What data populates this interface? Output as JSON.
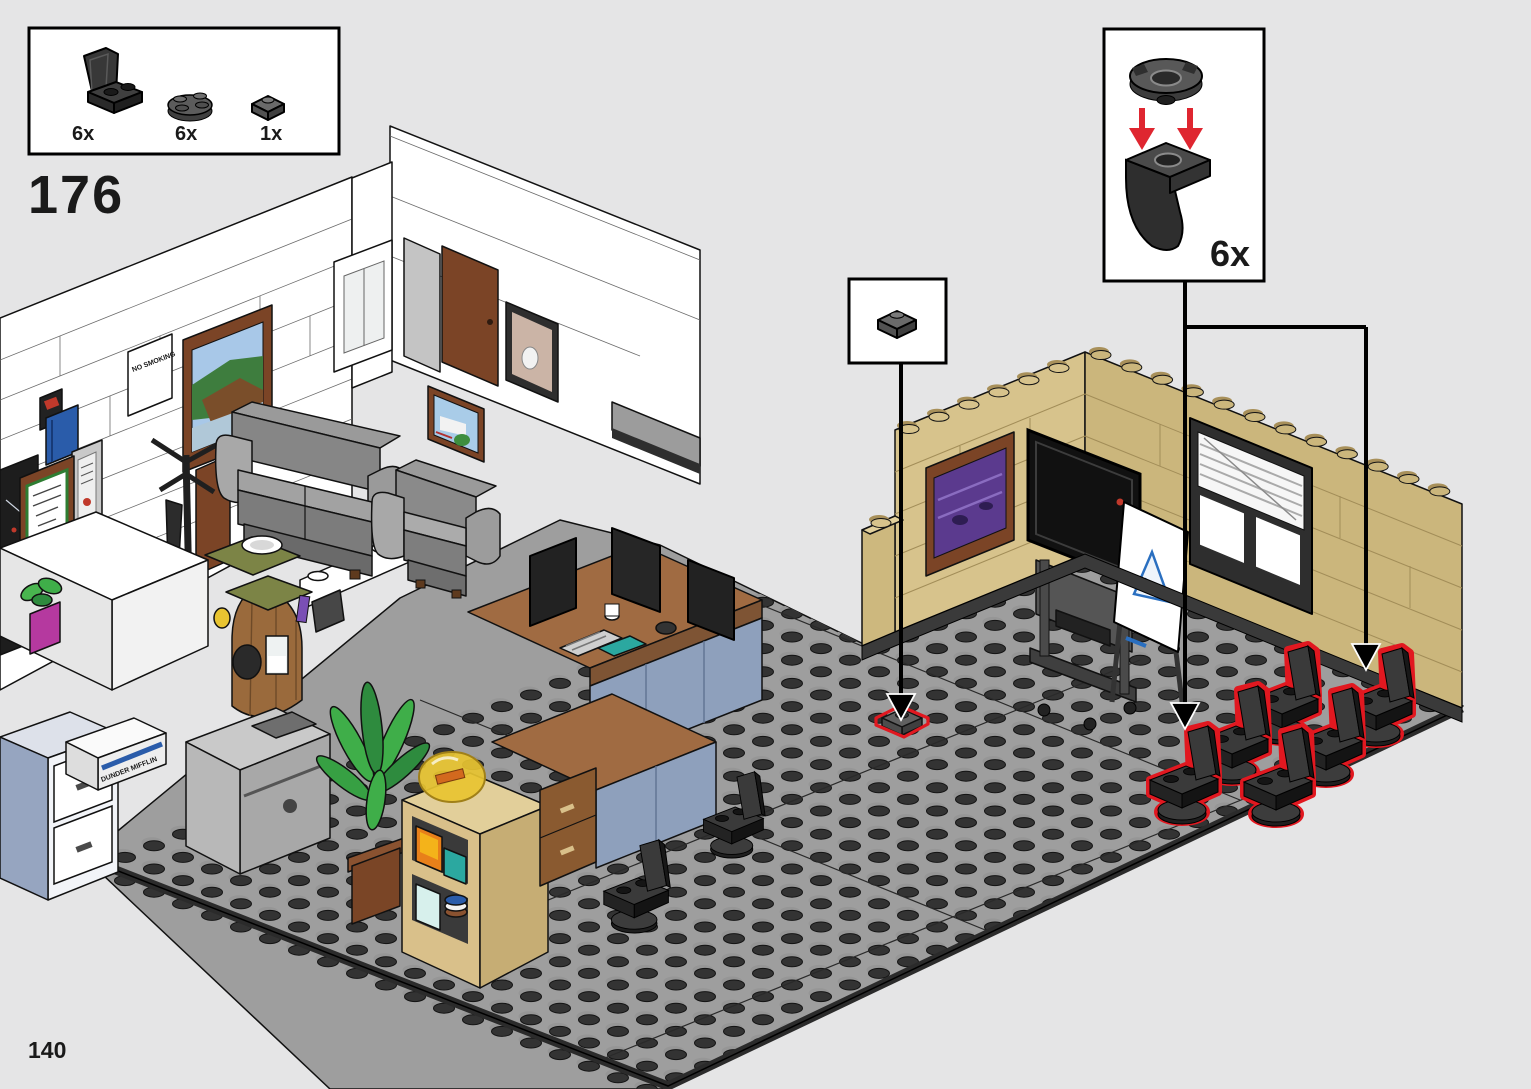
{
  "page": {
    "step_number": "176",
    "page_number": "140"
  },
  "parts_box": {
    "items": [
      {
        "icon": "lego-seat-2x2-icon",
        "count": "6x"
      },
      {
        "icon": "lego-round-plate-2x2-icon",
        "count": "6x"
      },
      {
        "icon": "lego-jumper-plate-1x2-icon",
        "count": "1x"
      }
    ]
  },
  "subassembly_callout": {
    "count": "6x",
    "parts": [
      "round-plate-2x2",
      "seat-2x2"
    ]
  },
  "placement_callout": {
    "part": "jumper-plate-1x2"
  },
  "illustration": {
    "paper_box_label": "DUNDER MIFFLIN",
    "wall_sign": "NO SMOKING",
    "highlighted_chairs": 6
  },
  "colors": {
    "highlight_red": "#e11820",
    "subassembly_arrow_red": "#df2630",
    "floor_gray": "#9e9e9e",
    "tan_wall": "#d7c38c",
    "background": "#e5e5e6"
  }
}
